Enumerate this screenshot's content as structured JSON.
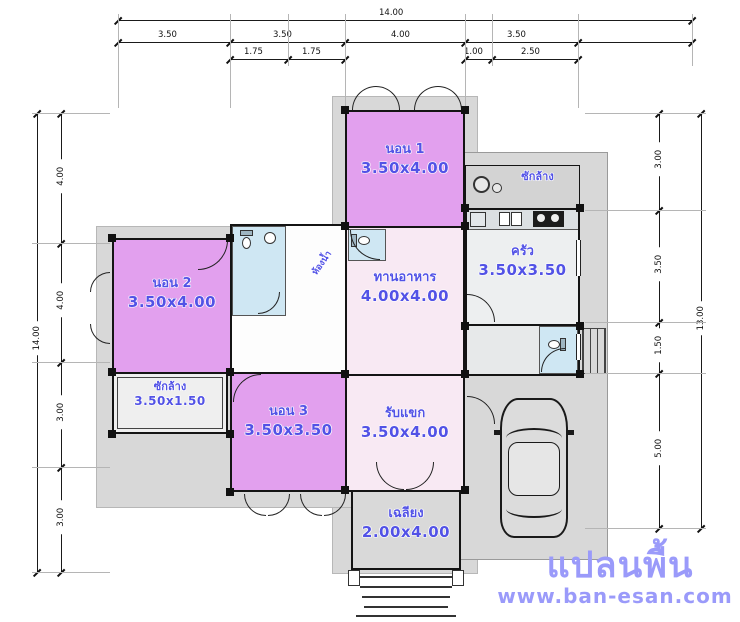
{
  "watermark": {
    "title": "แปลนพื้น",
    "site": "www.ban-esan.com"
  },
  "rooms": {
    "bedroom1": {
      "name": "นอน 1",
      "size": "3.50x4.00"
    },
    "bedroom2": {
      "name": "นอน 2",
      "size": "3.50x4.00"
    },
    "bedroom3": {
      "name": "นอน 3",
      "size": "3.50x3.50"
    },
    "dining": {
      "name": "ทานอาหาร",
      "size": "4.00x4.00"
    },
    "kitchen": {
      "name": "ครัว",
      "size": "3.50x3.50"
    },
    "living": {
      "name": "รับแขก",
      "size": "3.50x4.00"
    },
    "porch": {
      "name": "เฉลียง",
      "size": "2.00x4.00"
    },
    "laundry": {
      "name": "ซักล้าง",
      "size": "3.50x1.50"
    },
    "washyard": {
      "name": "ซักล้าง"
    },
    "bathroom": {
      "name": "ห้องน้ำ"
    }
  },
  "dimensions": {
    "top": {
      "total": "14.00",
      "segments": [
        "3.50",
        "3.50",
        "4.00",
        "3.50"
      ],
      "sub_mid": [
        "1.75",
        "1.75"
      ],
      "sub_right": [
        "1.00",
        "2.50"
      ]
    },
    "left": {
      "total": "14.00",
      "segments": [
        "4.00",
        "4.00",
        "3.00",
        "3.00"
      ]
    },
    "right": {
      "total": "13.00",
      "segments": [
        "3.00",
        "3.50",
        "1.50",
        "5.00"
      ]
    }
  },
  "colors": {
    "bedroom_fill": "#e2a0ee",
    "bath_fill": "#cfe7f3",
    "living_fill": "#f8e9f3",
    "ground": "#d8d8d8",
    "label_blue": "#5252e6",
    "watermark_blue": "#9a9afa"
  }
}
